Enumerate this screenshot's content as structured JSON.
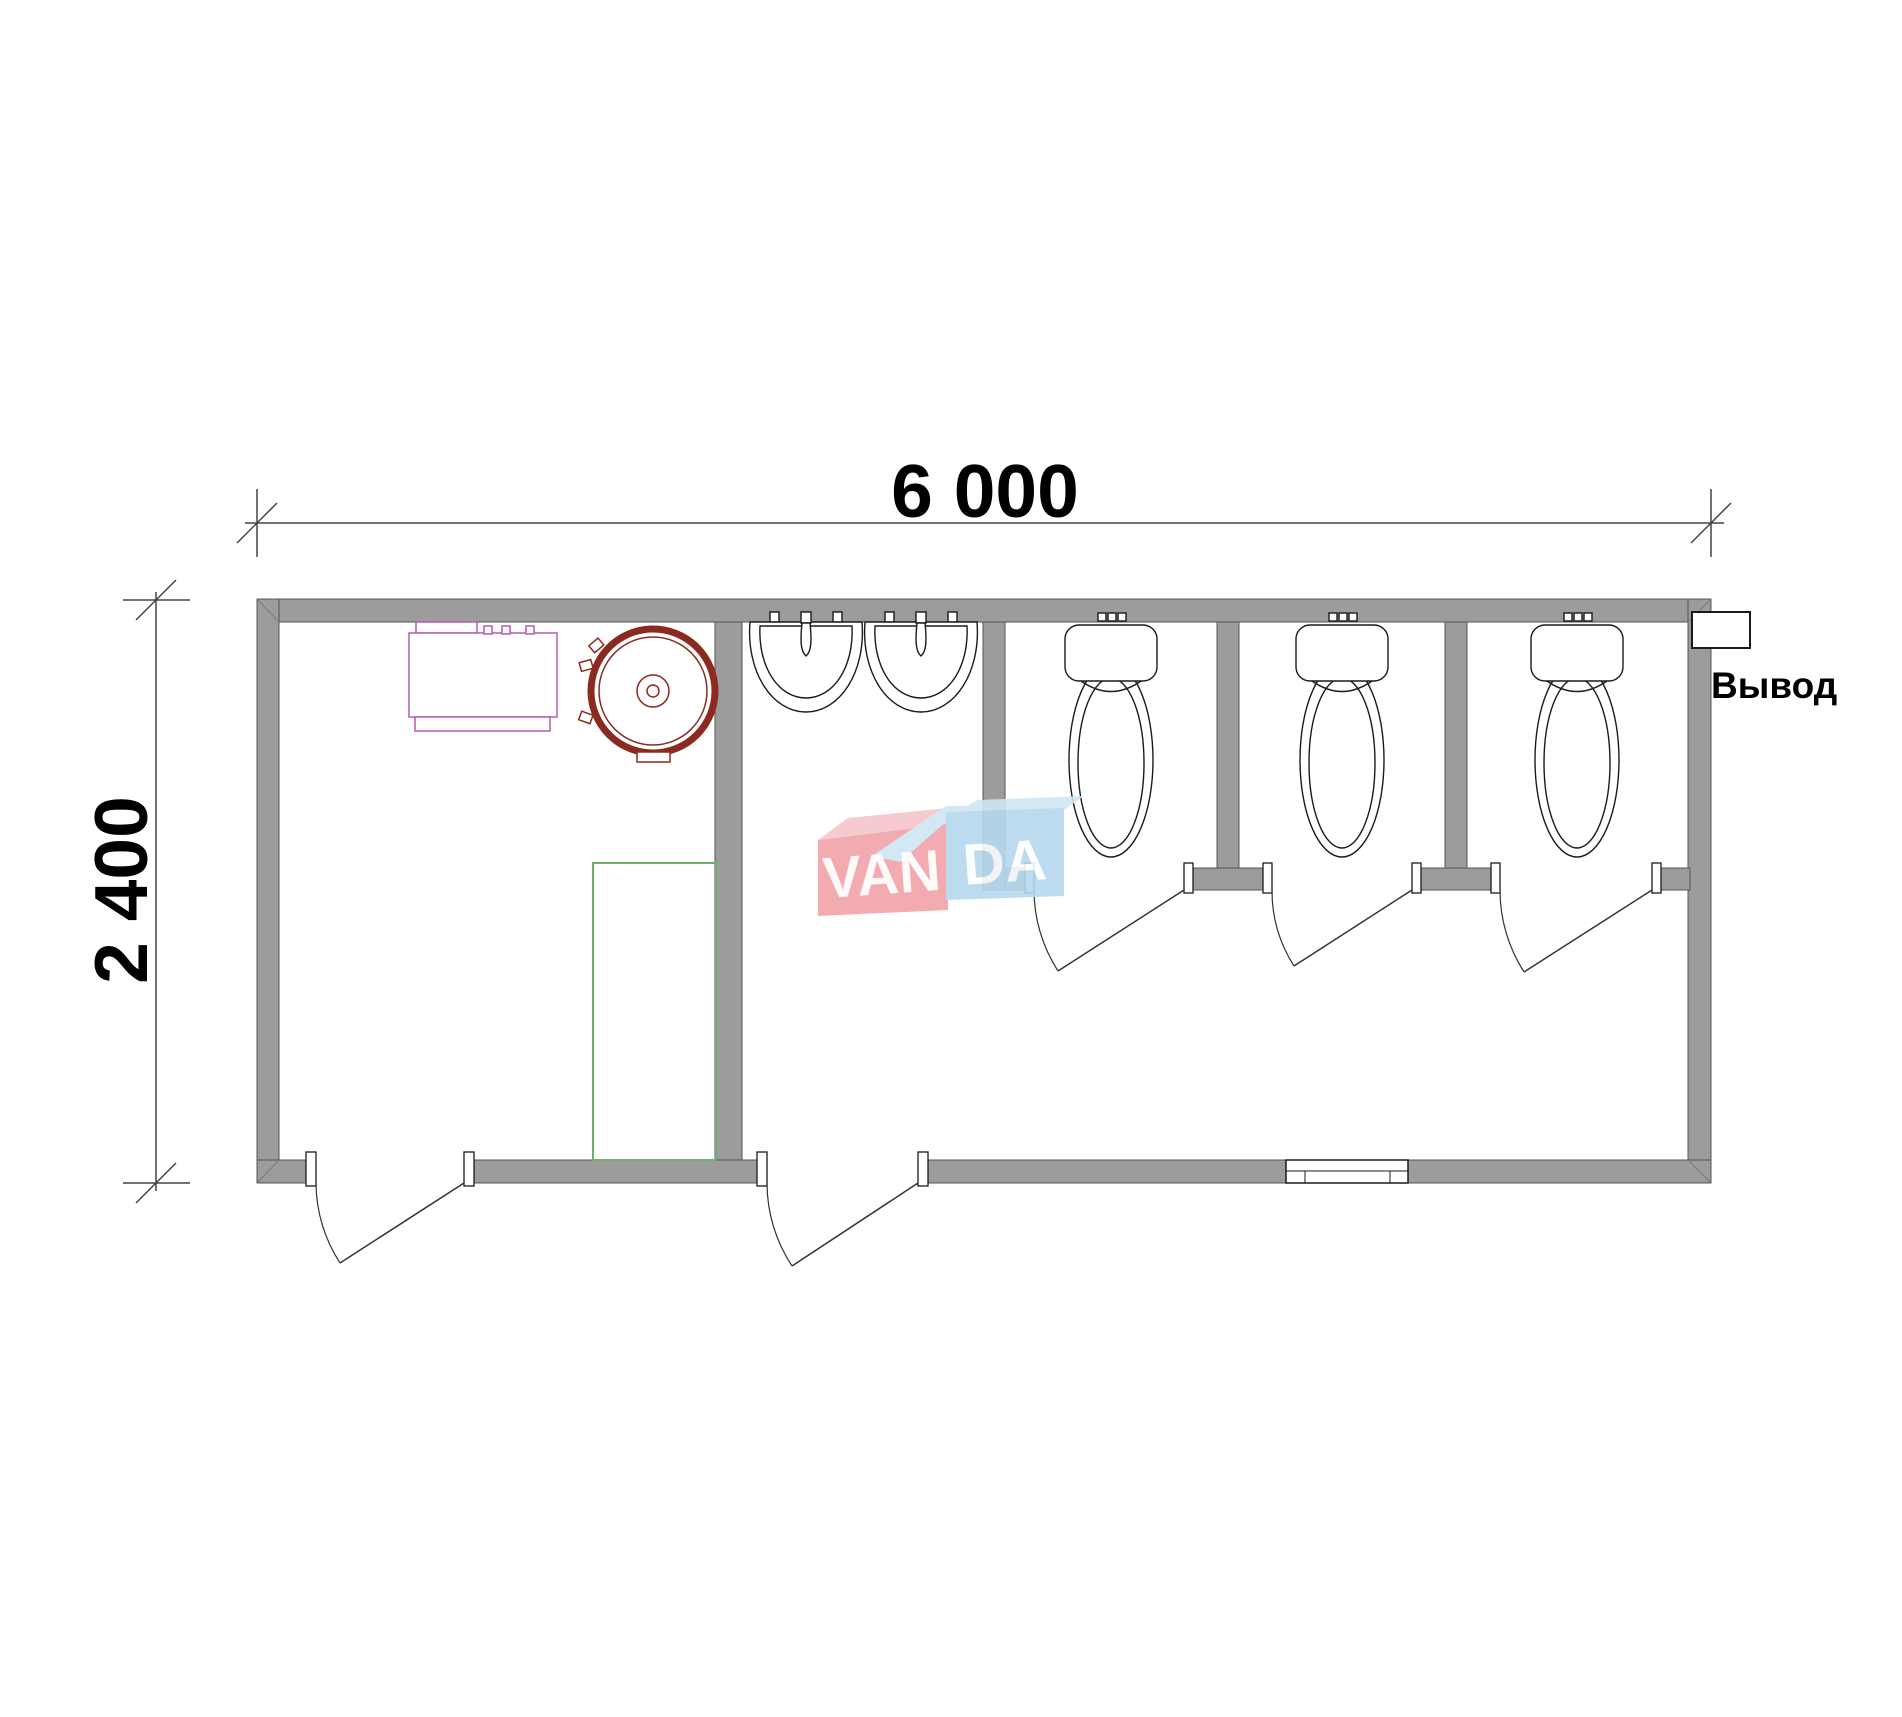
{
  "dimensions": {
    "width_label": "6 000",
    "height_label": "2 400"
  },
  "labels": {
    "outlet": "Вывод"
  },
  "watermark": {
    "left": "VAN",
    "right": "DA"
  },
  "fixtures": {
    "toilet_stalls": 3,
    "toilets": 3,
    "washbasins": 2,
    "exterior_doors": 2,
    "stall_doors": 3,
    "windows": 1,
    "shower_tray": 1,
    "round_water_tank": 1,
    "boiler_unit": 1,
    "outlet_boxes": 1
  },
  "colors": {
    "wall": "#9c9c9c",
    "wall-outline": "#555555",
    "line": "#1a1a1a",
    "door": "#333333",
    "dim": "#444444",
    "text": "#000000",
    "magenta": "#b35cb3",
    "red": "#8b2a1f",
    "green": "#6fae6f",
    "wm-pink": "#f0a2a9",
    "wm-pink-light": "#f6c6ca",
    "wm-blue": "#b5d8ee",
    "wm-blue-light": "#cfe6f4"
  }
}
